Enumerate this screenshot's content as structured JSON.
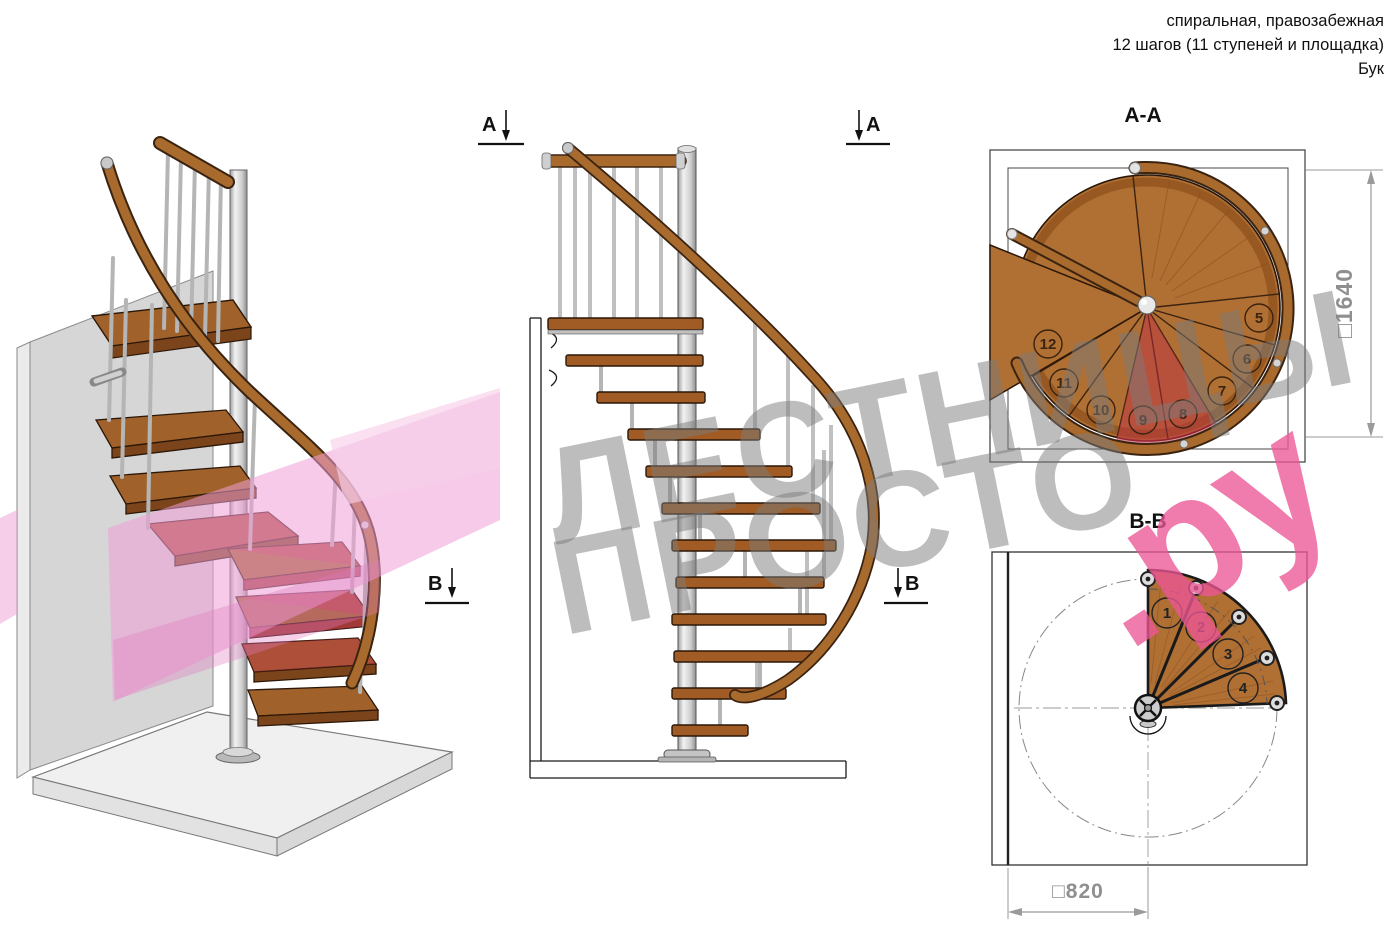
{
  "header": {
    "line1": "спиральная, правозабежная",
    "line2": "12 шагов (11 ступеней и площадка)",
    "line3": "Бук"
  },
  "watermark": {
    "word1": "ЛЕСТНИЦЫ",
    "word2": "ПРОСТО",
    "suffix": ".ру",
    "gray_color": "#7b7b7b",
    "pink_color": "#ec5696"
  },
  "views": {
    "front_elevation": {
      "section_marker_a": "А",
      "section_marker_b": "В"
    },
    "plan_aa": {
      "title": "А-А",
      "step_numbers": [
        "5",
        "6",
        "7",
        "8",
        "9",
        "10",
        "11",
        "12"
      ],
      "dimension_label": "□1640"
    },
    "plan_bb": {
      "title": "В-В",
      "step_numbers": [
        "1",
        "2",
        "3",
        "4"
      ],
      "dimension_label": "□820"
    }
  },
  "materials": {
    "wood": "#b06f33",
    "wood_dark": "#7c441a",
    "handrail": "#a96a2e",
    "metal": "#d9d9d9",
    "wall_gray": "#d6d6d6",
    "section_plane_pink": "#ef9ed6",
    "section_cut_red": "#c83c55",
    "dimension_gray": "#8f8f8f"
  }
}
